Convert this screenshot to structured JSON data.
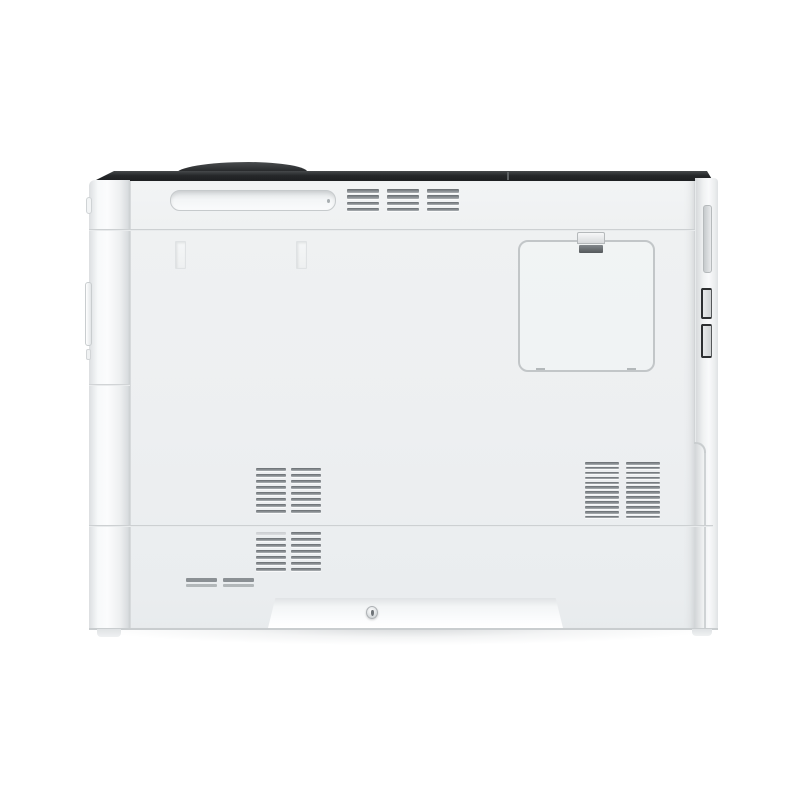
{
  "scene": {
    "type": "product-photo",
    "subject": "Laser printer, side view, centered on seamless white studio background",
    "background_color": "#ffffff",
    "visible_text": ""
  },
  "printer": {
    "body_color": "#edeff1",
    "top_strip_color": "#26282a",
    "seam_color": "#c3c7c9",
    "vent_slat_color": "#8a8f93",
    "latch_dark_color": "#54585b",
    "parts": {
      "top_cover_bump": "curved dark top-cover edge visible above body",
      "carry_handle_recess": "long recessed grip slot, upper left",
      "top_vent_grille": {
        "columns": 3,
        "slats_per_column": 4
      },
      "panel_slots": {
        "count": 2
      },
      "access_door": {
        "shape": "rounded square",
        "latch": "spring clip latch at top",
        "bottom_ticks": 2
      },
      "side_vent_upper": {
        "columns": 2,
        "slats_per_column": 8
      },
      "side_vent_lower": {
        "columns": 2,
        "slats_per_column": 7
      },
      "rear_vent_grille": {
        "columns": 2,
        "slats_per_column": 12
      },
      "info_labels": {
        "count": 2,
        "stripes_per_label": 2
      },
      "rear_interface_slot": "recessed vertical slot on rear edge",
      "rear_connector_bracket": {
        "segments": 2
      },
      "bottom_recess": {
        "shape": "trapezoid kick recess",
        "screws": 1
      },
      "body_seams": {
        "horizontal": 3,
        "note": "seams at top section, mid body, and front edge"
      }
    }
  }
}
